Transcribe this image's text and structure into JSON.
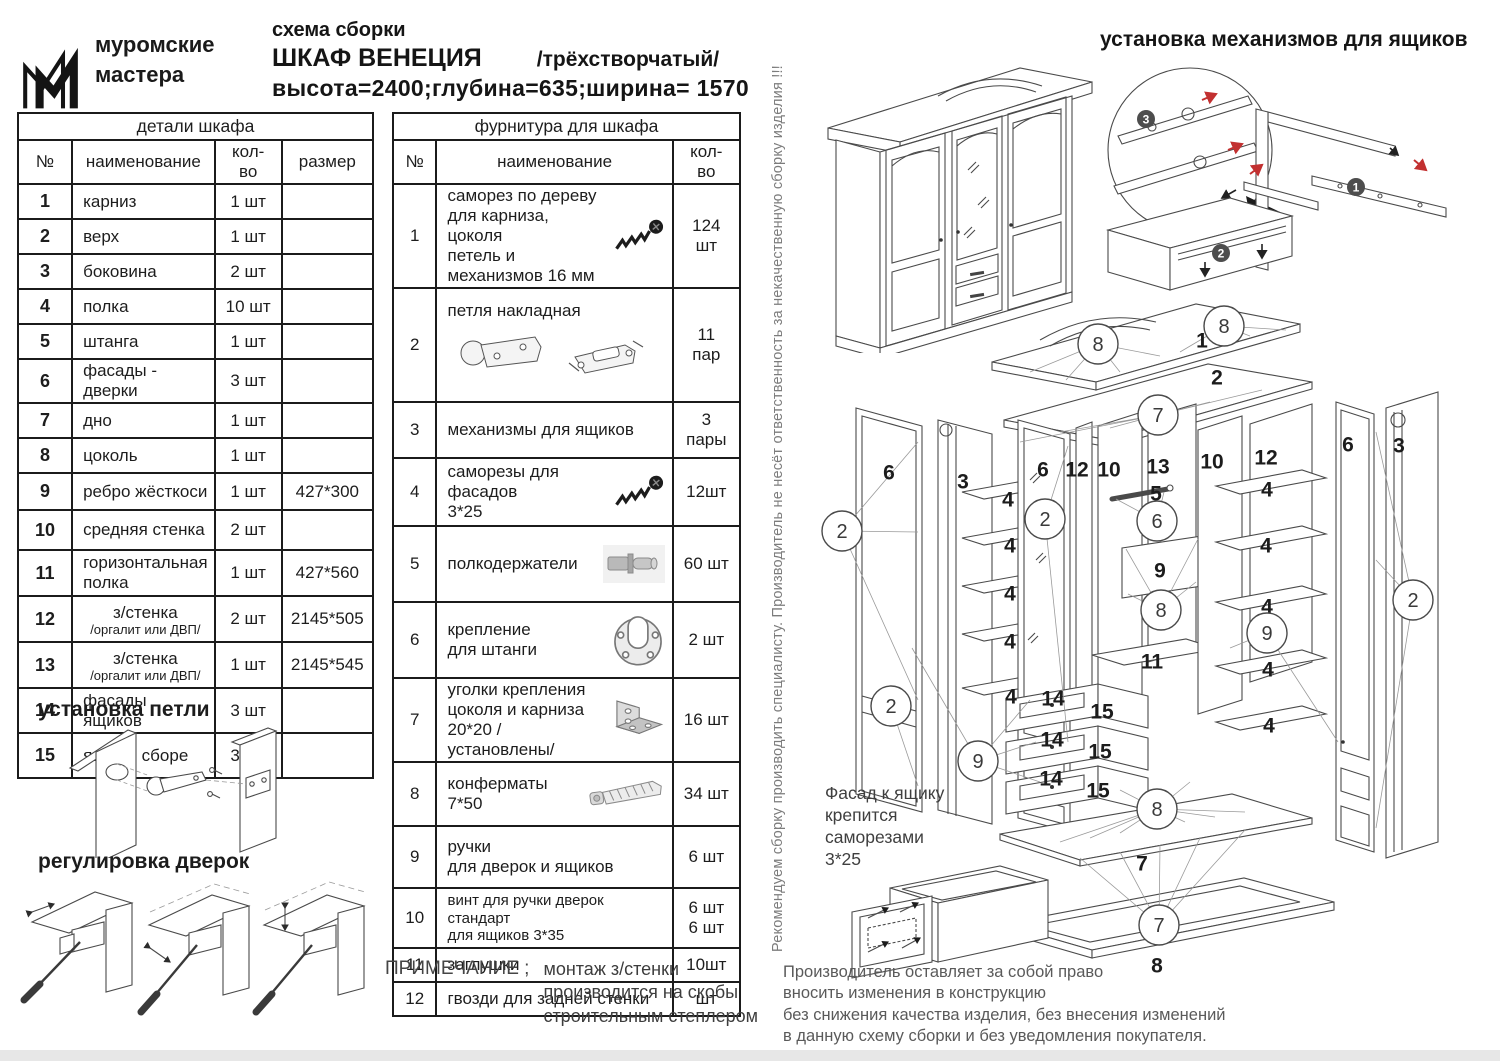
{
  "header": {
    "logo_line1": "муромские",
    "logo_line2": "мастера",
    "subtitle": "схема сборки",
    "title": "ШКАФ  ВЕНЕЦИЯ",
    "title_suffix": "/трёхстворчатый/",
    "dimensions": "высота=2400;глубина=635;ширина= 1570"
  },
  "parts_table": {
    "title": "детали шкафа",
    "headers": [
      "№",
      "наименование",
      "кол- во",
      "размер"
    ],
    "rows": [
      {
        "num": "1",
        "name": "карниз",
        "qty": "1 шт",
        "size": ""
      },
      {
        "num": "2",
        "name": "верх",
        "qty": "1 шт",
        "size": ""
      },
      {
        "num": "3",
        "name": "боковина",
        "qty": "2 шт",
        "size": ""
      },
      {
        "num": "4",
        "name": "полка",
        "qty": "10 шт",
        "size": ""
      },
      {
        "num": "5",
        "name": "штанга",
        "qty": "1 шт",
        "size": ""
      },
      {
        "num": "6",
        "name": "фасады - дверки",
        "qty": "3 шт",
        "size": ""
      },
      {
        "num": "7",
        "name": "дно",
        "qty": "1 шт",
        "size": ""
      },
      {
        "num": "8",
        "name": "цоколь",
        "qty": "1 шт",
        "size": ""
      },
      {
        "num": "9",
        "name": "ребро жёсткоси",
        "qty": "1 шт",
        "size": "427*300"
      },
      {
        "num": "10",
        "name": "средняя стенка",
        "qty": "2 шт",
        "size": ""
      },
      {
        "num": "11",
        "name": "горизонтальная полка",
        "qty": "1 шт",
        "size": "427*560"
      },
      {
        "num": "12",
        "name": "з/стенка",
        "sub": "/оргалит или ДВП/",
        "qty": "2 шт",
        "size": "2145*505"
      },
      {
        "num": "13",
        "name": "з/стенка",
        "sub": "/оргалит или ДВП/",
        "qty": "1 шт",
        "size": "2145*545"
      },
      {
        "num": "14",
        "name": "фасады ящиков",
        "qty": "3 шт",
        "size": ""
      },
      {
        "num": "15",
        "name": "ящик в сборе",
        "qty": "3 шт",
        "size": ""
      }
    ]
  },
  "hardware_table": {
    "title": "фурнитура для шкафа",
    "headers": [
      "№",
      "наименование",
      "кол- во"
    ],
    "rows": [
      {
        "num": "1",
        "name": "саморез по дереву\nдля карниза, цоколя\nпетель и механизмов  16 мм",
        "qty": "124 шт",
        "icon": "wood-screw-icon"
      },
      {
        "num": "2",
        "name": "петля накладная",
        "qty": "11\nпар",
        "icon": "hinge-icon",
        "icon_block": true
      },
      {
        "num": "3",
        "name": "механизмы для ящиков",
        "qty": "3\nпары"
      },
      {
        "num": "4",
        "name": "саморезы для фасадов\n3*25",
        "qty": "12шт",
        "icon": "wood-screw-icon"
      },
      {
        "num": "5",
        "name": "полкодержатели",
        "qty": "60 шт",
        "icon": "shelf-pin-icon"
      },
      {
        "num": "6",
        "name": "крепление\nдля штанги",
        "qty": "2 шт",
        "icon": "rod-bracket-icon"
      },
      {
        "num": "7",
        "name": "уголки крепления\nцоколя и карниза\n20*20 /установлены/",
        "qty": "16 шт",
        "icon": "corner-bracket-icon"
      },
      {
        "num": "8",
        "name": "конферматы\n7*50",
        "qty": "34 шт",
        "icon": "confirmat-icon"
      },
      {
        "num": "9",
        "name": "ручки\nдля дверок и ящиков",
        "qty": "6 шт"
      },
      {
        "num": "10",
        "name": "винт для ручки дверок стандарт\nдля ящиков  3*35",
        "qty": "6 шт\n6 шт"
      },
      {
        "num": "11",
        "name": "заглушки",
        "qty": "10шт"
      },
      {
        "num": "12",
        "name": "гвозди для задней стенки",
        "qty": "шт"
      }
    ]
  },
  "sections": {
    "hinge_install_title": "установка  петли",
    "door_adjust_title": "регулировка дверок",
    "drawer_mech_title": "установка механизмов для ящиков"
  },
  "notes": {
    "note_label": "ПРИМЕЧАНИЕ ;",
    "note_text": "монтаж з/стенки\nпроизводится на скобы\nстроительным степлером",
    "vertical_disclaimer": "Рекомендуем сборку производить специалисту. Производитель не несёт ответственность за некачественную сборку изделия !!!",
    "facade_note": "Фасад к ящику\nкрепится\nсаморезами\n3*25",
    "manufacturer_note": "Производитель оставляет за собой право\nвносить изменения в конструкцию\nбез снижения качества изделия, без внесения изменений\nв данную схему сборки и без уведомления покупателя."
  },
  "diagram": {
    "part_labels": [
      {
        "t": "1",
        "x": 1202,
        "y": 341
      },
      {
        "t": "2",
        "x": 1217,
        "y": 378
      },
      {
        "t": "6",
        "x": 889,
        "y": 473
      },
      {
        "t": "3",
        "x": 963,
        "y": 482
      },
      {
        "t": "6",
        "x": 1043,
        "y": 470
      },
      {
        "t": "12",
        "x": 1077,
        "y": 470
      },
      {
        "t": "10",
        "x": 1109,
        "y": 470
      },
      {
        "t": "13",
        "x": 1158,
        "y": 467
      },
      {
        "t": "10",
        "x": 1212,
        "y": 462
      },
      {
        "t": "12",
        "x": 1266,
        "y": 458
      },
      {
        "t": "5",
        "x": 1156,
        "y": 494
      },
      {
        "t": "9",
        "x": 1160,
        "y": 571
      },
      {
        "t": "11",
        "x": 1152,
        "y": 662
      },
      {
        "t": "6",
        "x": 1348,
        "y": 445
      },
      {
        "t": "3",
        "x": 1399,
        "y": 446
      },
      {
        "t": "4",
        "x": 1008,
        "y": 500
      },
      {
        "t": "4",
        "x": 1010,
        "y": 546
      },
      {
        "t": "4",
        "x": 1010,
        "y": 594
      },
      {
        "t": "4",
        "x": 1010,
        "y": 642
      },
      {
        "t": "4",
        "x": 1011,
        "y": 697
      },
      {
        "t": "4",
        "x": 1267,
        "y": 490
      },
      {
        "t": "4",
        "x": 1266,
        "y": 546
      },
      {
        "t": "4",
        "x": 1267,
        "y": 607
      },
      {
        "t": "4",
        "x": 1268,
        "y": 670
      },
      {
        "t": "4",
        "x": 1269,
        "y": 726
      },
      {
        "t": "14",
        "x": 1053,
        "y": 699
      },
      {
        "t": "15",
        "x": 1102,
        "y": 712
      },
      {
        "t": "14",
        "x": 1052,
        "y": 740
      },
      {
        "t": "15",
        "x": 1100,
        "y": 752
      },
      {
        "t": "14",
        "x": 1051,
        "y": 779
      },
      {
        "t": "15",
        "x": 1098,
        "y": 791
      },
      {
        "t": "7",
        "x": 1142,
        "y": 864
      },
      {
        "t": "8",
        "x": 1157,
        "y": 966
      }
    ],
    "circle_labels": [
      {
        "t": "8",
        "x": 1098,
        "y": 344
      },
      {
        "t": "8",
        "x": 1224,
        "y": 326
      },
      {
        "t": "7",
        "x": 1158,
        "y": 415
      },
      {
        "t": "2",
        "x": 842,
        "y": 531
      },
      {
        "t": "2",
        "x": 891,
        "y": 706
      },
      {
        "t": "2",
        "x": 1045,
        "y": 519
      },
      {
        "t": "6",
        "x": 1157,
        "y": 521
      },
      {
        "t": "8",
        "x": 1161,
        "y": 610
      },
      {
        "t": "9",
        "x": 1267,
        "y": 633
      },
      {
        "t": "2",
        "x": 1413,
        "y": 600
      },
      {
        "t": "9",
        "x": 978,
        "y": 761
      },
      {
        "t": "8",
        "x": 1157,
        "y": 809
      },
      {
        "t": "7",
        "x": 1159,
        "y": 925
      }
    ],
    "badges": [
      {
        "t": "3",
        "x": 1146,
        "y": 119
      },
      {
        "t": "1",
        "x": 1356,
        "y": 187
      },
      {
        "t": "2",
        "x": 1221,
        "y": 253
      }
    ]
  }
}
